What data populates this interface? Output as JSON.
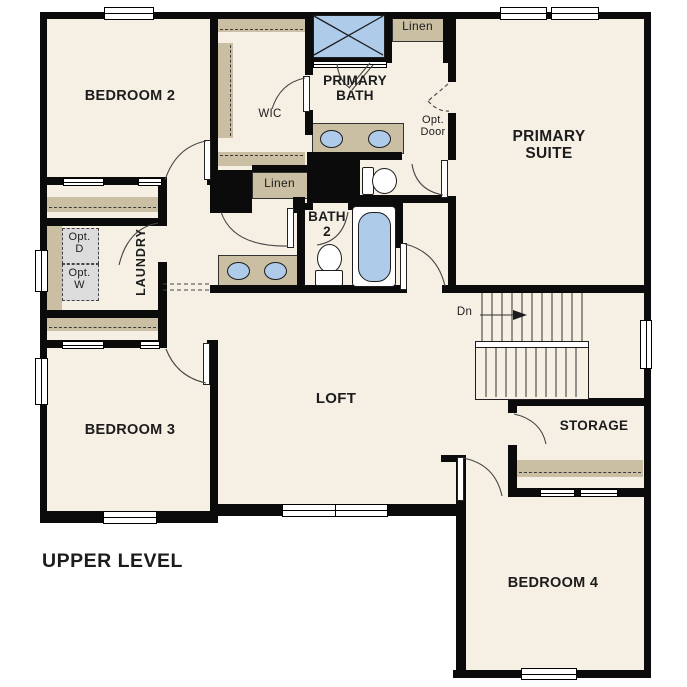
{
  "plan": {
    "title": "UPPER LEVEL"
  },
  "rooms": {
    "bedroom2": "BEDROOM 2",
    "bedroom3": "BEDROOM 3",
    "bedroom4": "BEDROOM 4",
    "primary_suite_l1": "PRIMARY",
    "primary_suite_l2": "SUITE",
    "primary_bath_l1": "PRIMARY",
    "primary_bath_l2": "BATH",
    "bath2_l1": "BATH",
    "bath2_l2": "2",
    "loft": "LOFT",
    "storage": "STORAGE",
    "wic": "WIC",
    "laundry": "LAUNDRY",
    "linen_upper": "Linen",
    "linen_hall": "Linen"
  },
  "annotations": {
    "opt_door_l1": "Opt.",
    "opt_door_l2": "Door",
    "opt_dryer_l1": "Opt.",
    "opt_dryer_l2": "D",
    "opt_washer_l1": "Opt.",
    "opt_washer_l2": "W",
    "stairs_down": "Dn"
  },
  "colors": {
    "floor": "#f5efe4",
    "wall": "#0b0b0b",
    "cabinetry": "#cbbfa3",
    "fixtures": "#aecbea",
    "optional_appliance": "#dcdcdc"
  }
}
